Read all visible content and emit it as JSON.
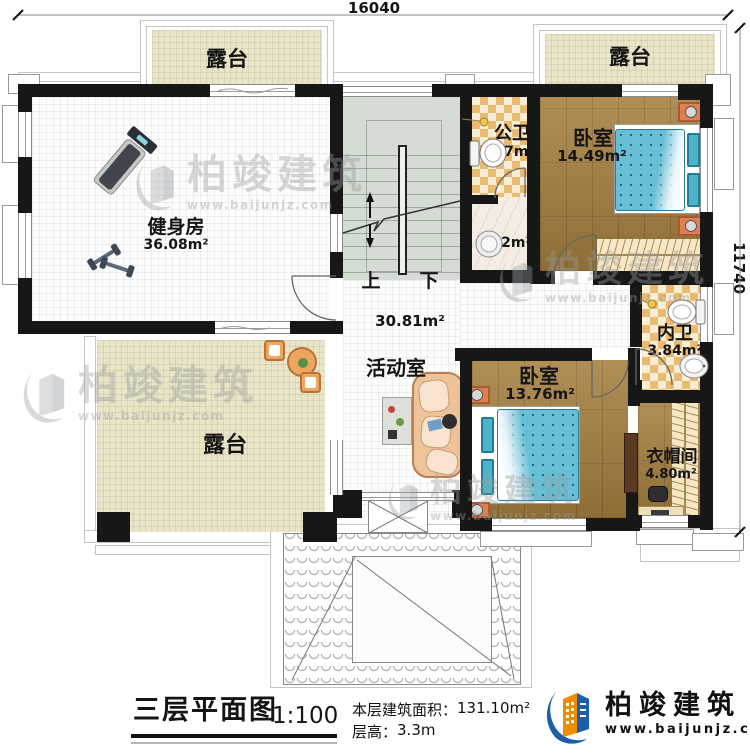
{
  "dimensions": {
    "width": "16040",
    "height": "11740"
  },
  "rooms": {
    "terrace_tl": {
      "label": "露台"
    },
    "terrace_tr": {
      "label": "露台"
    },
    "terrace_bottom": {
      "label": "露台"
    },
    "gym": {
      "label": "健身房",
      "area": "36.08m²"
    },
    "public_bath": {
      "label": "公卫",
      "area": "3.37m²"
    },
    "shower": {
      "area": "2.62m²"
    },
    "bedroom1": {
      "label": "卧室",
      "area": "14.49m²"
    },
    "inner_bath": {
      "label": "内卫",
      "area": "3.84m²"
    },
    "activity": {
      "label": "活动室",
      "area": "30.81m²"
    },
    "bedroom2": {
      "label": "卧室",
      "area": "13.76m²"
    },
    "cloakroom": {
      "label": "衣帽间",
      "area": "4.80m²"
    }
  },
  "stairs": {
    "up": "上",
    "down": "下"
  },
  "footer": {
    "title": "三层平面图",
    "scale": "1:100",
    "area_label": "本层建筑面积：",
    "area_value": "131.10m²",
    "floor_height_label": "层高：",
    "floor_height_value": "3.3m"
  },
  "brand": {
    "name": "柏竣建筑",
    "website": "www.baijunjz.com"
  },
  "colors": {
    "wall": "#171717",
    "wood_floor": "#a5803f",
    "terrace_floor": "#eae5c6",
    "tile_accent": "#e9ba70",
    "bed_blue": "#68bed5",
    "stair_green": "#d4dcd3",
    "logo_blue": "#1c5fa8",
    "logo_orange": "#f08c00"
  }
}
